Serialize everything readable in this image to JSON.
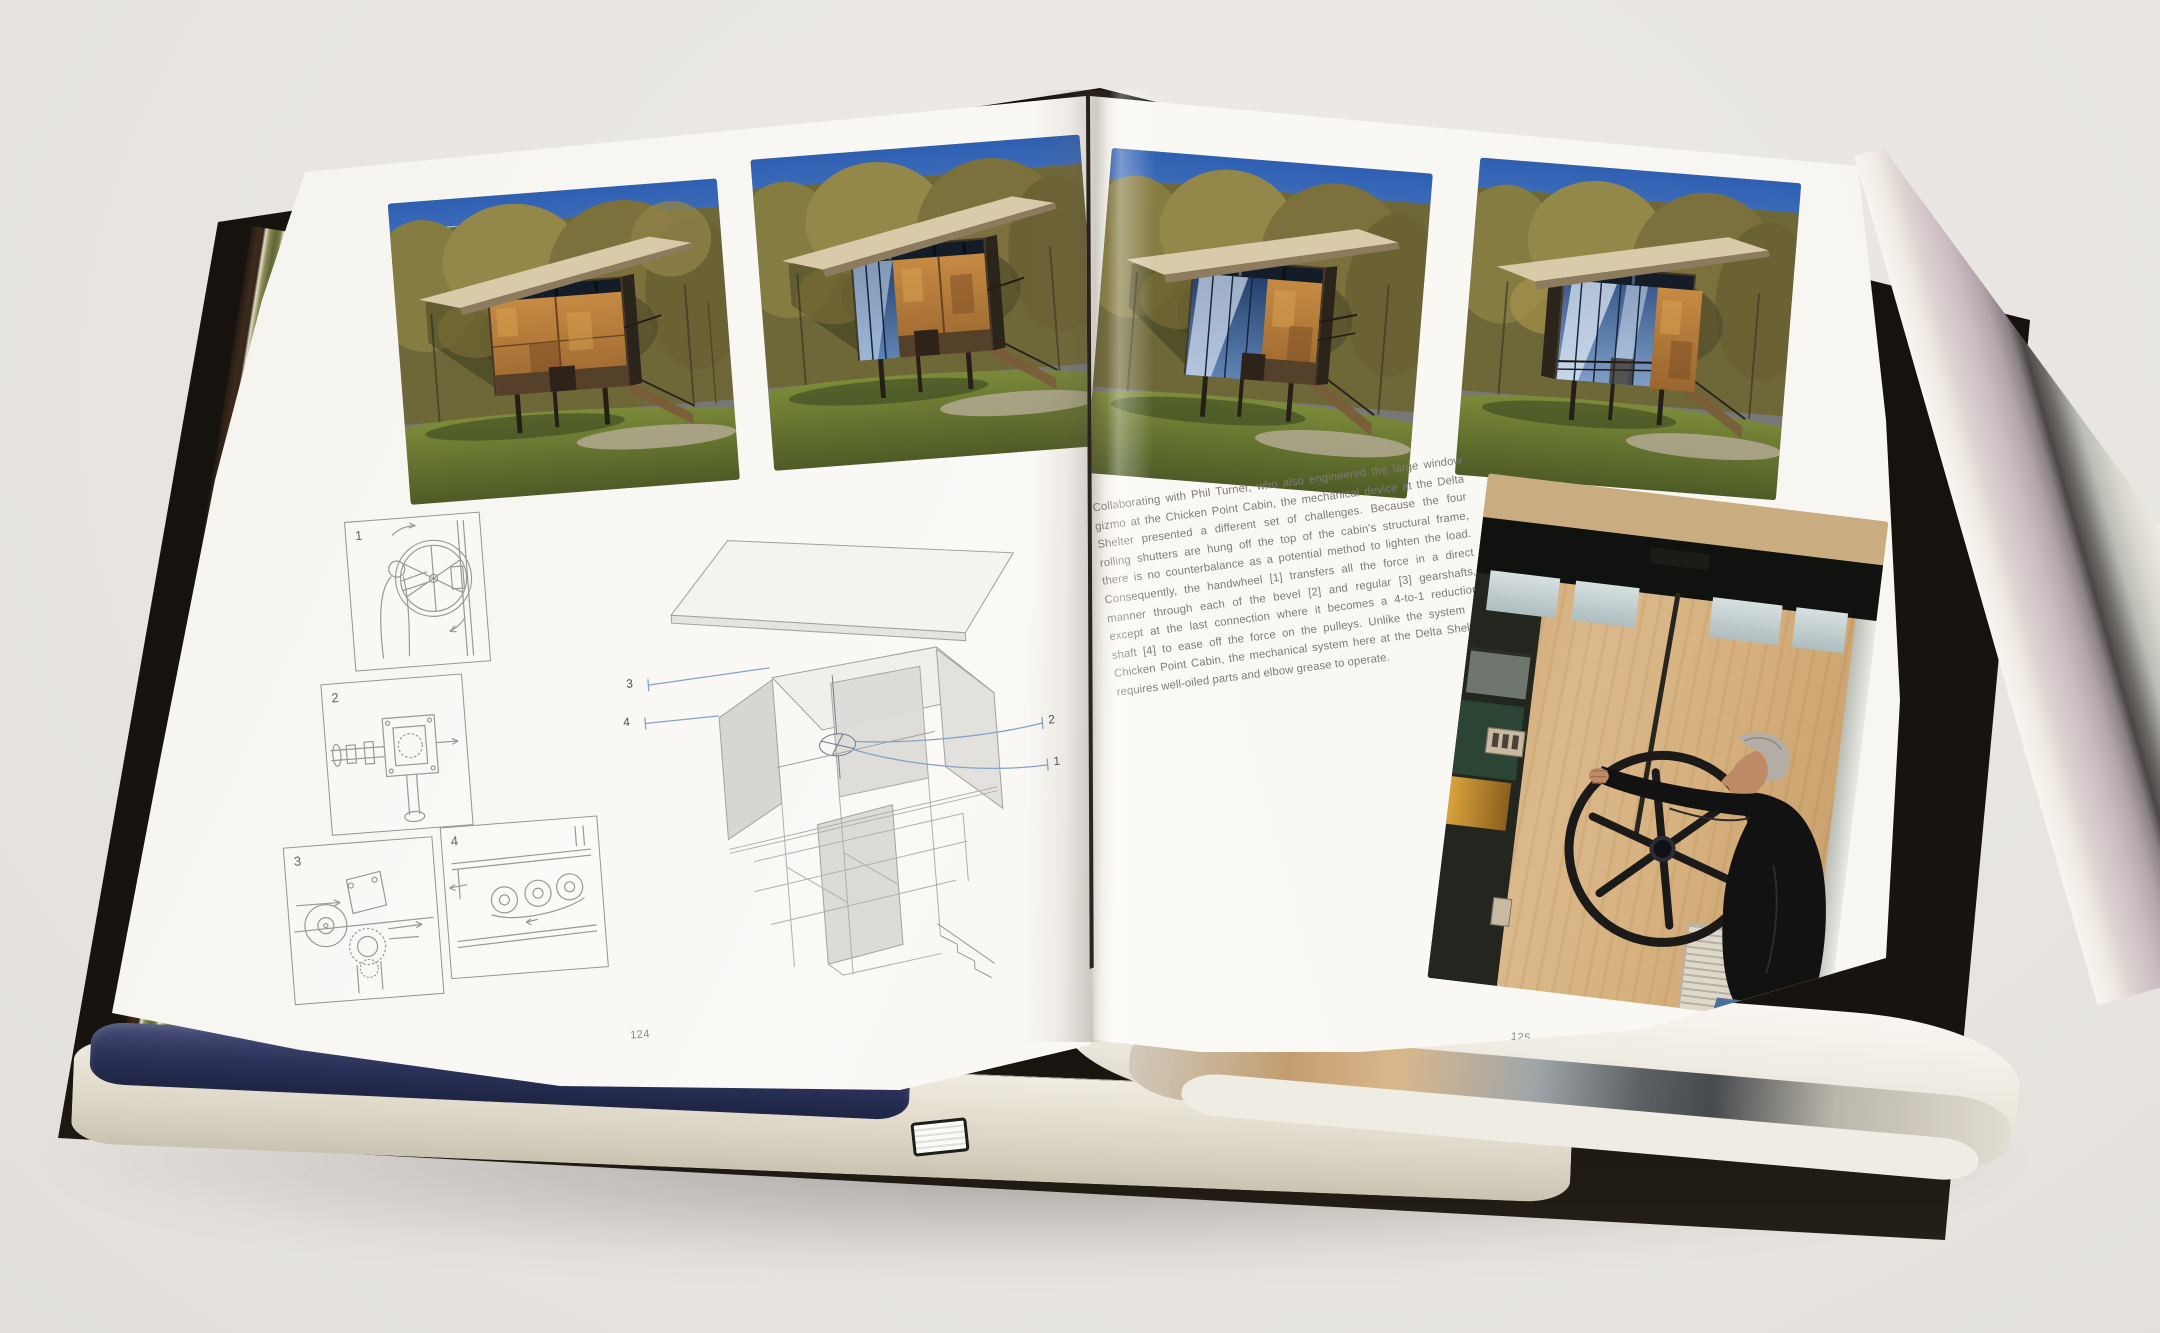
{
  "scene": {
    "description": "Open hardcover architecture book photographed on a light gray surface; spread pages 124-125 about the Delta Shelter shutter mechanism"
  },
  "palette": {
    "background": "#e9e6e2",
    "cover_black": "#16120d",
    "page_white": "#f8f6f1",
    "text_gray": "#7e7a74",
    "leader_blue": "#87a2c4",
    "rust_shutter": "#b0763c",
    "sky_blue": "#3465b5",
    "plywood": "#d9b584",
    "jeans_blue": "#4d6f9a",
    "blue_page_edge": "#2a3158"
  },
  "left_page": {
    "page_number": "124",
    "photos": [
      {
        "alt": "Delta Shelter cabin with steel shutters fully closed, autumn trees"
      },
      {
        "alt": "Delta Shelter cabin with shutters starting to open, one glass bay exposed"
      }
    ],
    "diagrams": [
      {
        "number": "1",
        "alt": "Figure turning the handwheel"
      },
      {
        "number": "2",
        "alt": "Bevel gearshaft assembly"
      },
      {
        "number": "3",
        "alt": "Regular gearshaft and reduction drum"
      },
      {
        "number": "4",
        "alt": "4-to-1 reduction shaft and pulleys"
      }
    ],
    "axon": {
      "alt": "Exploded axonometric of cabin showing shutter drive mechanism",
      "labels": {
        "left_top": "3",
        "left_bottom": "4",
        "right_top": "2",
        "right_bottom": "1"
      }
    }
  },
  "right_page": {
    "page_number": "125",
    "photos": [
      {
        "alt": "Delta Shelter cabin with shutters mostly open"
      },
      {
        "alt": "Delta Shelter cabin with shutters fully open revealing glass facade"
      }
    ],
    "paragraph_lines": [
      "Collaborating with Phil Turner, who also engineered the large window",
      "gizmo at the Chicken Point Cabin, the mechanical device at the Delta",
      "Shelter presented a different set of challenges. Because the four",
      "rolling shutters are hung off the top of the cabin's structural frame,",
      "there is no counterbalance as a potential method to lighten the load.",
      "Consequently, the handwheel [1] transfers all the force in a direct",
      "manner through each of the bevel [2] and regular [3] gearshafts,",
      "except at the last connection where it becomes a 4-to-1 reduction",
      "shaft [4] to ease off the force on the pulleys. Unlike the system at",
      "Chicken Point Cabin, the mechanical system here at the Delta Shelter",
      "requires well-oiled parts and elbow grease to operate."
    ],
    "large_photo": {
      "alt": "Man in black fleece and jeans turning the large steel handwheel beside a plywood shutter panel"
    }
  }
}
